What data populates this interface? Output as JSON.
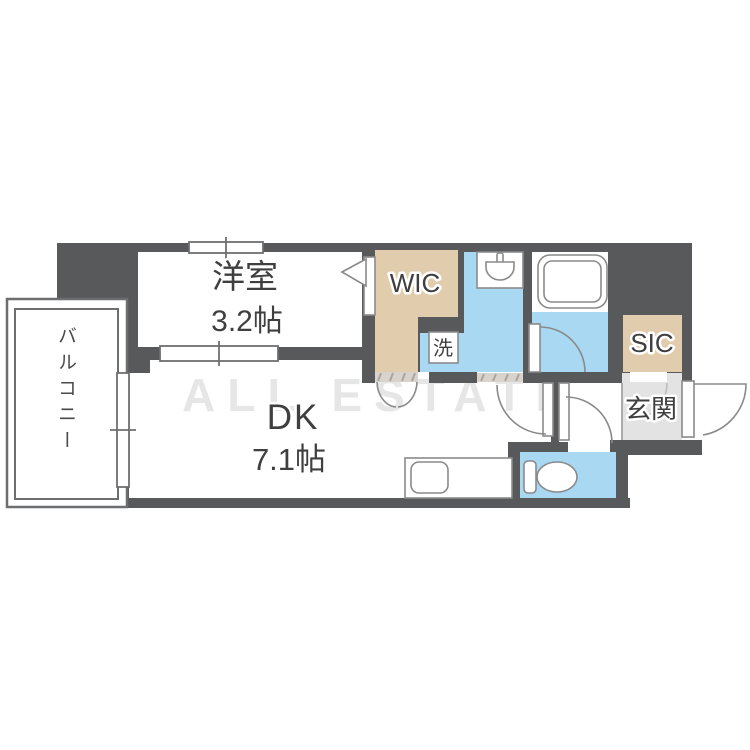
{
  "plan": {
    "watermark": "ALL ESTATE",
    "rooms": {
      "western_room": {
        "name": "洋室",
        "size": "3.2帖"
      },
      "dining_kitchen": {
        "name": "DK",
        "size": "7.1帖"
      },
      "walk_in_closet": {
        "label": "WIC"
      },
      "shoe_in_closet": {
        "label": "SIC"
      },
      "entrance": {
        "label": "玄関"
      },
      "laundry": {
        "label": "洗"
      },
      "balcony": {
        "label": "バルコニー"
      }
    },
    "colors": {
      "wall": "#58595b",
      "water_area_blue": "#a9d8f2",
      "closet_beige": "#e2ccae",
      "entrance_gray": "#e3e3e3",
      "threshold": "#d8d4cd",
      "fixture_stroke": "#8a8a8a",
      "label_text": "#3f3f3f",
      "watermark_gray": "#d7d7d7"
    }
  }
}
